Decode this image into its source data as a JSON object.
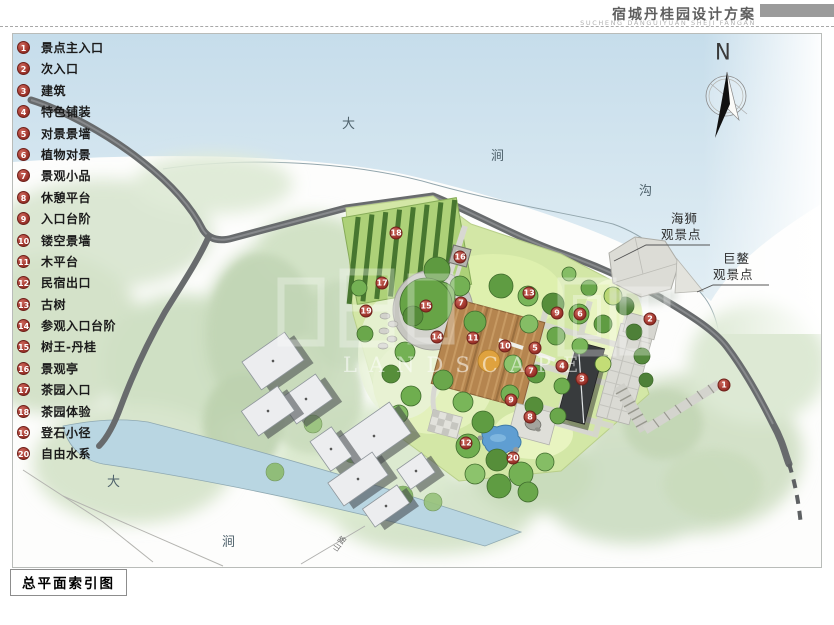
{
  "header": {
    "title": "宿城丹桂园设计方案",
    "subtitle": "SUCHENG DANGUIYUAN SHEJI FANGAN"
  },
  "caption": "总平面索引图",
  "compass": {
    "label": "N"
  },
  "legend": {
    "items": [
      {
        "num": "1",
        "label": "景点主入口"
      },
      {
        "num": "2",
        "label": "次入口"
      },
      {
        "num": "3",
        "label": "建筑"
      },
      {
        "num": "4",
        "label": "特色铺装"
      },
      {
        "num": "5",
        "label": "对景景墙"
      },
      {
        "num": "6",
        "label": "植物对景"
      },
      {
        "num": "7",
        "label": "景观小品"
      },
      {
        "num": "8",
        "label": "休憩平台"
      },
      {
        "num": "9",
        "label": "入口台阶"
      },
      {
        "num": "10",
        "label": "镂空景墙"
      },
      {
        "num": "11",
        "label": "木平台"
      },
      {
        "num": "12",
        "label": "民宿出口"
      },
      {
        "num": "13",
        "label": "古树"
      },
      {
        "num": "14",
        "label": "参观入口台阶"
      },
      {
        "num": "15",
        "label": "树王-丹桂"
      },
      {
        "num": "16",
        "label": "景观亭"
      },
      {
        "num": "17",
        "label": "茶园入口"
      },
      {
        "num": "18",
        "label": "茶园体验"
      },
      {
        "num": "19",
        "label": "登石小径"
      },
      {
        "num": "20",
        "label": "自由水系"
      }
    ]
  },
  "map": {
    "watermark_text": "LANDSCAPE",
    "water_labels": [
      {
        "text": "大",
        "x": 329,
        "y": 79
      },
      {
        "text": "涧",
        "x": 478,
        "y": 111
      },
      {
        "text": "沟",
        "x": 626,
        "y": 146
      },
      {
        "text": "大",
        "x": 94,
        "y": 437
      },
      {
        "text": "涧",
        "x": 209,
        "y": 497
      }
    ],
    "path_label": {
      "text": "山路",
      "x": 318,
      "y": 504
    },
    "viewpoints": [
      {
        "line1": "海狮",
        "line2": "观景点"
      },
      {
        "line1": "巨鳌",
        "line2": "观景点"
      }
    ],
    "markers": [
      {
        "n": "1",
        "x": 711,
        "y": 351
      },
      {
        "n": "2",
        "x": 637,
        "y": 285
      },
      {
        "n": "3",
        "x": 569,
        "y": 345
      },
      {
        "n": "4",
        "x": 549,
        "y": 332
      },
      {
        "n": "5",
        "x": 522,
        "y": 314
      },
      {
        "n": "6",
        "x": 567,
        "y": 280
      },
      {
        "n": "7",
        "x": 518,
        "y": 337
      },
      {
        "n": "7",
        "x": 448,
        "y": 269
      },
      {
        "n": "8",
        "x": 517,
        "y": 383
      },
      {
        "n": "9",
        "x": 544,
        "y": 279
      },
      {
        "n": "9",
        "x": 498,
        "y": 366
      },
      {
        "n": "10",
        "x": 492,
        "y": 312
      },
      {
        "n": "11",
        "x": 460,
        "y": 304
      },
      {
        "n": "12",
        "x": 453,
        "y": 409
      },
      {
        "n": "13",
        "x": 516,
        "y": 259
      },
      {
        "n": "14",
        "x": 424,
        "y": 303
      },
      {
        "n": "15",
        "x": 413,
        "y": 272
      },
      {
        "n": "16",
        "x": 447,
        "y": 223
      },
      {
        "n": "17",
        "x": 369,
        "y": 249
      },
      {
        "n": "18",
        "x": 383,
        "y": 199
      },
      {
        "n": "19",
        "x": 353,
        "y": 277
      },
      {
        "n": "20",
        "x": 500,
        "y": 424
      }
    ]
  },
  "colors": {
    "marker_red": "#a63a31",
    "wall_gray": "#686b6d",
    "water_blue": "#c9dfec",
    "pond_blue": "#5f9ed2",
    "lawn_green": "#d3e7a6",
    "deck_brown": "#b5854f"
  }
}
